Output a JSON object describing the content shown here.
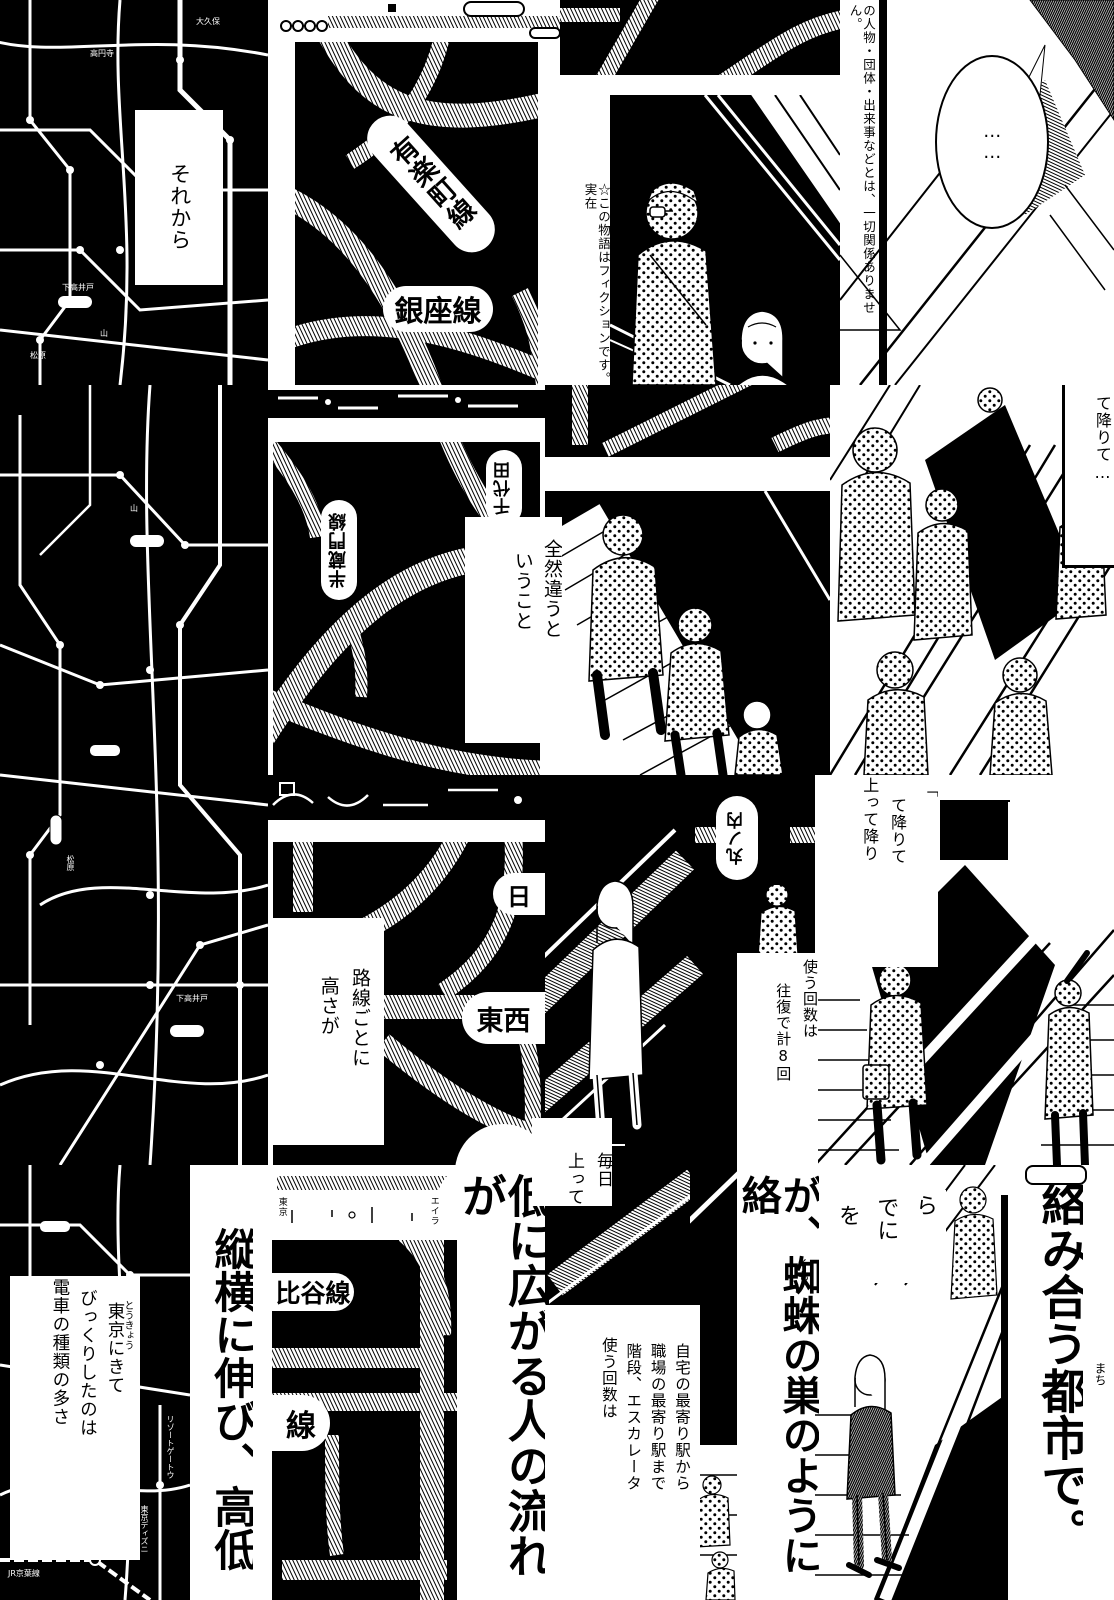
{
  "page": {
    "background": "#ffffff",
    "ink": "#000000"
  },
  "captions": {
    "sorekara": "それから",
    "fiction_1": "☆この物語はフィクションです。実在",
    "fiction_2": "の人物・団体・出来事などとは、一切関係ありません。",
    "ellipsis_bubble": "……",
    "zenzen_col1": "全然違うと",
    "zenzen_col2": "いうこと",
    "te_orite": "て降りて…",
    "rosen_col1": "路線ごとに",
    "rosen_col2": "高さが",
    "kaidan_col1": "「",
    "kaidan_col2": "て降りて",
    "kaidan_col3": "上って降り",
    "ofuku_col1": "使う回数は",
    "ofuku_col2": "往復で計8回",
    "mainichi_col1": "毎日",
    "mainichi_col2": "上って",
    "tokyo_col1": "東京にきて",
    "tokyo_col1_furigana": "とうきょう",
    "tokyo_col2": "びっくりしたのは",
    "tokyo_col3": "電車の種類の多さ",
    "big_1": "縦横に伸び、高低",
    "big_2": "低に広がる人の流れが",
    "big_3": "が、蜘蛛の巣のように絡",
    "big_3_furigana": "くも",
    "big_4": "絡み合う都市で。",
    "big_4_furigana": "まち",
    "jitaku_col1": "自宅の最寄り駅から",
    "jitaku_col2": "職場の最寄り駅まで",
    "jitaku_col3": "階段、エスカレータ",
    "jitaku_col4": "使う回数は",
    "frag_col1": "ら",
    "frag_col2": "でに",
    "frag_col3": "を"
  },
  "line_labels": {
    "yurakucho": "有楽町線",
    "ginza": "銀座線",
    "hanzomon": "半蔵門線",
    "chiyoda": "千代田",
    "marunouchi": "丸ノ内",
    "hibiya_start": "日",
    "tozai": "東西",
    "hibiya_rest": "比谷線",
    "sen": "線"
  },
  "map_labels": {
    "m1": "下高井戸",
    "m2": "大久保",
    "m3": "高円寺",
    "m4": "松原",
    "m5": "山",
    "m6": "リゾートゲートウ",
    "m7": "東京ディズニ",
    "m8": "JR京葉線",
    "m9": "東京",
    "m10": "エイラ"
  }
}
